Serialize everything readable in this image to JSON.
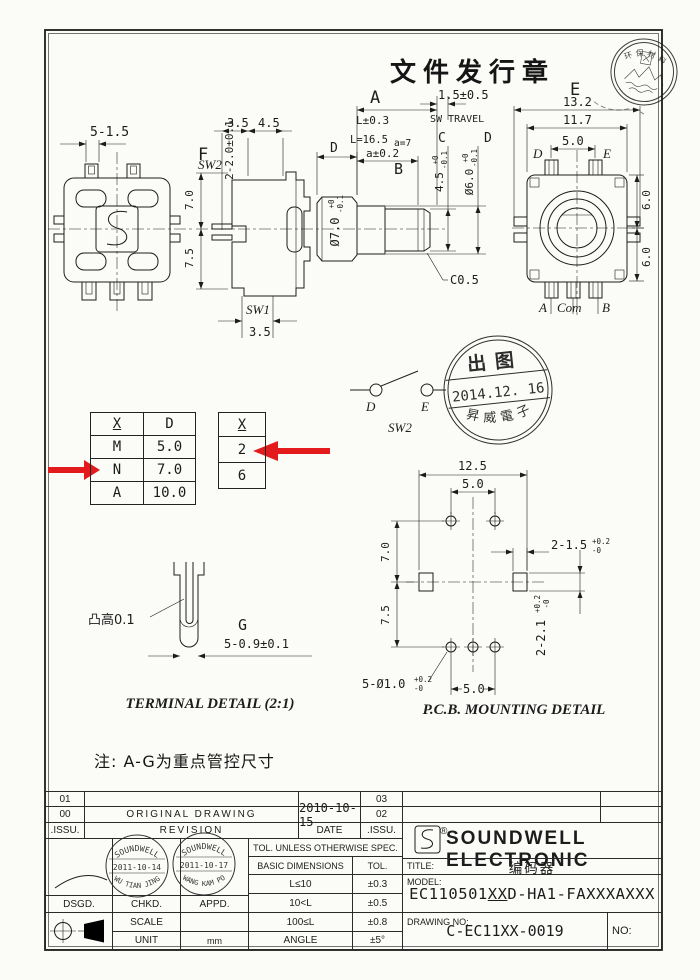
{
  "page": {
    "doc_stamp": "文件发行章",
    "note": "注: A-G为重点管控尺寸"
  },
  "seal": {
    "text_top": "环保材料"
  },
  "front_view": {
    "dim_pins": "5-1.5"
  },
  "side_view": {
    "label_f": "F",
    "dim_f": "2-2.0±0.1",
    "dim_a": "3.5",
    "dim_b": "4.5",
    "sw2": "SW2",
    "sw1": "SW1",
    "dim_sw1": "3.5",
    "dim_upper": "7.0",
    "dim_lower": "7.5",
    "label_d": "D",
    "shaft_dia": "Ø7.0",
    "shaft_dia_plus": "+0",
    "shaft_dia_minus": "-0.1"
  },
  "shaft": {
    "label_a": "A",
    "dim_l": "L±0.3",
    "dim_l_val": "L=16.5",
    "dim_a_val": "a=7",
    "dim_a_tol": "a±0.2",
    "label_b": "B",
    "sw_travel_dim": "1.5±0.5",
    "sw_travel": "SW TRAVEL",
    "label_c": "C",
    "label_d": "D",
    "dim_c": "4.5",
    "dim_c_plus": "+0",
    "dim_c_minus": "-0.1",
    "dim_d": "Ø6.0",
    "dim_d_plus": "+0",
    "dim_d_minus": "-0.1",
    "chamfer": "C0.5"
  },
  "rear_view": {
    "label_e": "E",
    "dim_w1": "13.2",
    "dim_w2": "11.7",
    "dim_pin": "5.0",
    "pin_d": "D",
    "pin_e": "E",
    "dim_h1": "6.0",
    "dim_h2": "6.0",
    "pin_a": "A",
    "pin_com": "Com",
    "pin_b": "B"
  },
  "table_xd": {
    "headers": [
      "X",
      "D"
    ],
    "rows": [
      [
        "M",
        "5.0"
      ],
      [
        "N",
        "7.0"
      ],
      [
        "A",
        "10.0"
      ]
    ]
  },
  "table_x": {
    "header": "X",
    "rows": [
      "2",
      "6"
    ]
  },
  "sw2_symbol": {
    "d": "D",
    "e": "E",
    "label": "SW2"
  },
  "release_stamp": {
    "line1": "出图",
    "line2": "2014.12. 16",
    "line3": "昇威電子"
  },
  "pcb": {
    "dim_w": "12.5",
    "dim_pin_top": "5.0",
    "dim_h1": "7.0",
    "dim_h2": "7.5",
    "dim_slot1": "2-1.5",
    "dim_slot1_plus": "+0.2",
    "dim_slot1_minus": "-0",
    "dim_slot2": "2-2.1",
    "dim_slot2_plus": "+0.2",
    "dim_slot2_minus": "-0",
    "dim_holes": "5-Ø1.0",
    "dim_holes_plus": "+0.2",
    "dim_holes_minus": "-0",
    "dim_pin_bottom": "5.0",
    "title": "P.C.B. MOUNTING DETAIL"
  },
  "terminal": {
    "bump": "凸高0.1",
    "label_g": "G",
    "dim": "5-0.9±0.1",
    "title": "TERMINAL DETAIL (2:1)"
  },
  "revision_table": {
    "rows": [
      [
        "01",
        "",
        "",
        "03",
        "",
        ""
      ],
      [
        "00",
        "ORIGINAL DRAWING",
        "2010-10-15",
        "02",
        "",
        ""
      ],
      [
        ".ISSU.",
        "REVISION",
        "DATE",
        ".ISSU."
      ]
    ]
  },
  "title_block": {
    "signature": "张伟",
    "stamp1": {
      "brand": "SOUNDWELL",
      "date": "2011-10-14",
      "name": "WU TIAN JING"
    },
    "stamp2": {
      "brand": "SOUNDWELL",
      "date": "2011-10-17",
      "name": "WANG KAM PO"
    },
    "dsgd": "DSGD.",
    "chkd": "CHKD.",
    "appd": "APPD.",
    "scale": "SCALE",
    "unit": "UNIT",
    "unit_value": "mm",
    "tol_header": "TOL. UNLESS OTHERWISE SPEC.",
    "basic_dim": "BASIC DIMENSIONS",
    "tol": "TOL.",
    "tol_rows": [
      [
        "L≤10",
        "±0.3"
      ],
      [
        "10<L",
        "±0.5"
      ],
      [
        "100≤L",
        "±0.8"
      ],
      [
        "ANGLE",
        "±5°"
      ]
    ],
    "company": "SOUNDWELL ELECTRONIC",
    "reg": "®",
    "title_label": "TITLE:",
    "title_value": "编码器",
    "model_label": "MODEL:",
    "model_prefix": "EC110501",
    "model_xx": "XX",
    "model_suffix": "D-HA1-FAXXXAXXX",
    "drawing_no_label": "DRAWING NO:",
    "drawing_no": "C-EC11XX-0019",
    "no_label": "NO:"
  },
  "colors": {
    "arrow_red": "#e31b1c",
    "line": "#1c1c1c",
    "paper": "#fbfbf8"
  }
}
